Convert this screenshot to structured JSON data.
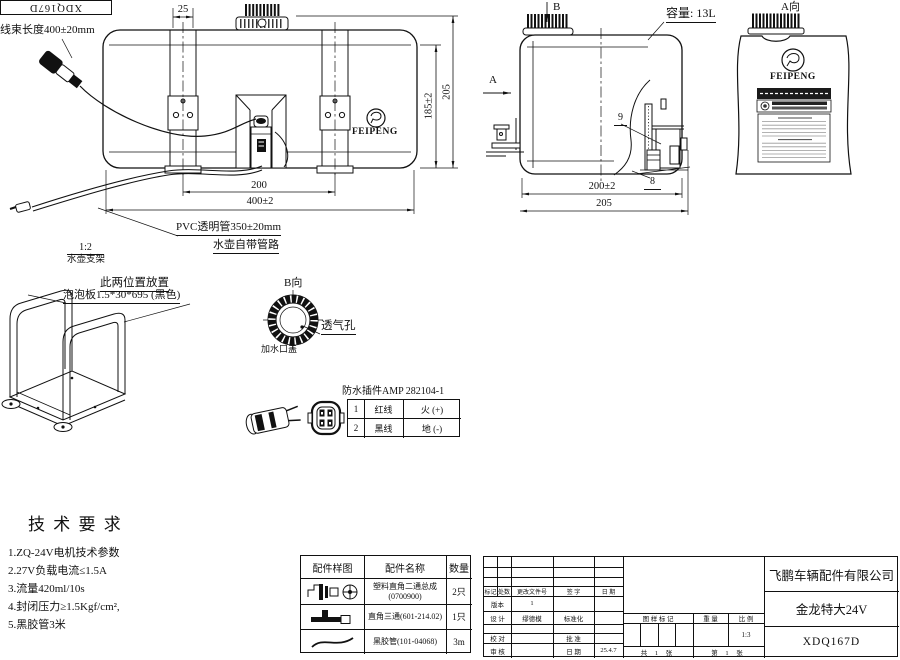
{
  "sheet": {
    "part_no_box": "XDQ167D",
    "harness_note": "线束长度400±20mm",
    "capacity_note": "容量: 13L",
    "pvc_note": "PVC透明管350±20mm",
    "pipe_note": "水壶自带管路",
    "brand": "FEIPENG"
  },
  "views": {
    "front": {
      "dim_top": "25",
      "dim_inner": "200",
      "dim_width": "400±2",
      "dim_h1": "185±2",
      "dim_h2": "205"
    },
    "side": {
      "label_a": "A",
      "label_b": "B",
      "dim_w1": "200±2",
      "dim_w2": "205",
      "part_9": "9",
      "part_8": "8"
    },
    "a_view": {
      "title": "A向",
      "brand": "FEIPENG"
    },
    "b_view": {
      "title": "B向",
      "vent": "透气孔",
      "filler_cap": "加水口盖"
    },
    "bracket": {
      "scale": "1:2",
      "name": "水壶支架",
      "note_place": "此两位置放置",
      "note_foam": "泡泡板1.5*30*695 (黑色)"
    }
  },
  "connector": {
    "title": "防水插件AMP 282104-1",
    "rows": [
      {
        "no": "1",
        "wire": "红线",
        "polarity": "火 (+)"
      },
      {
        "no": "2",
        "wire": "黑线",
        "polarity": "地 (-)"
      }
    ]
  },
  "tech_req": {
    "title": "技 术 要 求",
    "items": [
      "1.ZQ-24V电机技术参数",
      "2.27V负载电流≤1.5A",
      "3.流量420ml/10s",
      "4.封闭压力≥1.5Kgf/cm²,",
      "5.黑胶管3米"
    ]
  },
  "parts_table": {
    "col_sample": "配件样图",
    "col_name": "配件名称",
    "col_qty": "数量",
    "rows": [
      {
        "name1": "塑料直角二通总成",
        "name2": "(0700900)",
        "qty": "2只"
      },
      {
        "name1": "直角三通(601-214.02)",
        "name2": "",
        "qty": "1只"
      },
      {
        "name1": "黑胶管(101-04068)",
        "name2": "",
        "qty": "3m"
      }
    ]
  },
  "title_block": {
    "company": "飞鹏车辆配件有限公司",
    "product": "金龙特大24V",
    "drawing_no": "XDQ167D",
    "rev": {
      "mark": "标记",
      "count": "处数",
      "file": "更改文件号",
      "sign": "签 字",
      "date": "日 期"
    },
    "version_label": "版本",
    "version_value": "1",
    "design_label": "设 计",
    "designer": "缪德模",
    "standard_label": "标准化",
    "check_label": "校 对",
    "approve_label": "批 准",
    "audit_label": "审 核",
    "date_label": "日 期",
    "date_value": "25.4.7",
    "mark_label": "图 样 标 记",
    "weight_label": "重 量",
    "scale_label": "比 例",
    "scale_value": "1:3",
    "sheets_total": "共 1 张",
    "sheet_no": "第 1 张"
  }
}
